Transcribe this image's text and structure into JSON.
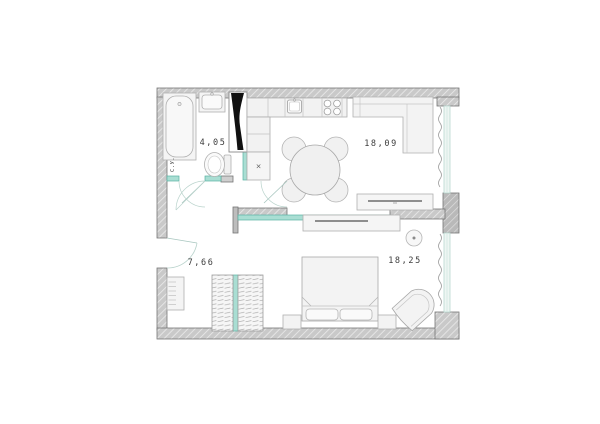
{
  "plan": {
    "rooms": [
      {
        "id": "bathroom",
        "area_label": "4,05",
        "name_label": "С.У."
      },
      {
        "id": "kitchen-living",
        "area_label": "18,09"
      },
      {
        "id": "hallway",
        "area_label": "7,66"
      },
      {
        "id": "bedroom",
        "area_label": "18,25"
      }
    ],
    "symbols": {
      "washing_machine": "×"
    },
    "colors": {
      "wall_gray": "#c9c9c9",
      "wall_line": "#757575",
      "accent_teal_fill": "#a9ded3",
      "accent_teal_line": "#58b2a3",
      "furniture_fill": "#f4f4f4",
      "furniture_line": "#b0b0b0",
      "shaft_black": "#111111"
    }
  }
}
